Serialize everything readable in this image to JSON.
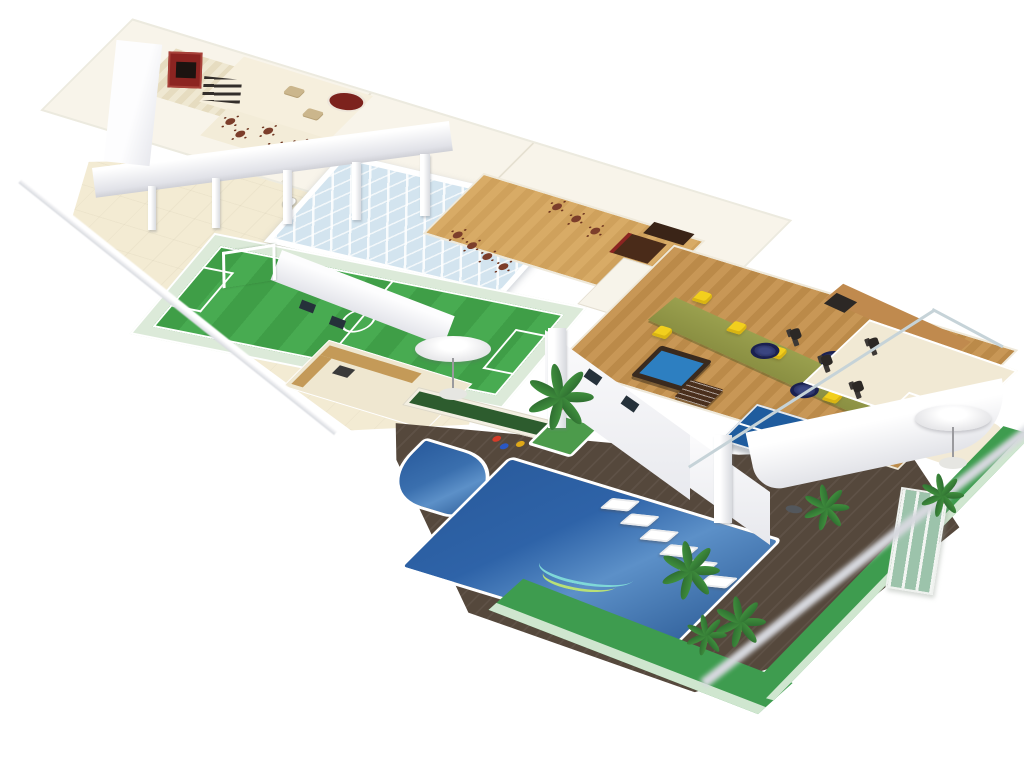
{
  "scene": {
    "type": "isometric-3d-amenity-floorplan-render",
    "areas": [
      {
        "id": "home-cinema",
        "label": "home cinema",
        "color_key": "red-wall",
        "seat_rows": 3
      },
      {
        "id": "lounge",
        "label": "lounge"
      },
      {
        "id": "round-bar",
        "label": "round bar",
        "color_key": "bar-red"
      },
      {
        "id": "upper-dining-terrace",
        "label": "roof dining terrace",
        "tables": 6
      },
      {
        "id": "skylight",
        "label": "glass skylight roof",
        "color_key": "glass-blue"
      },
      {
        "id": "party-hall",
        "label": "party hall",
        "color_key": "wood-hall",
        "tables": 7
      },
      {
        "id": "hall-bar",
        "label": "party hall bar counter"
      },
      {
        "id": "open-terrace",
        "label": "open paved terrace",
        "color_key": "terrace-sand"
      },
      {
        "id": "soccer-field",
        "label": "mini soccer field",
        "color_key": "field-green",
        "goal": 1
      },
      {
        "id": "bbq-area",
        "label": "barbecue / grill area"
      },
      {
        "id": "parasol-seating",
        "label": "parasol with table and chairs",
        "count": 2
      },
      {
        "id": "planter-hedge",
        "label": "hedge planter"
      },
      {
        "id": "kids-pool",
        "label": "kids pool",
        "color_key": "pool-blue"
      },
      {
        "id": "main-pool",
        "label": "swimming pool",
        "color_key": "pool-blue"
      },
      {
        "id": "palm-island",
        "label": "palm island planter"
      },
      {
        "id": "sun-deck",
        "label": "timber sun deck",
        "color_key": "deck-wood",
        "loungers": 6
      },
      {
        "id": "game-room",
        "label": "games terrace",
        "color_key": "wood-game",
        "billiard_tables": 1,
        "foosball_tables": 1,
        "table_tennis_tables": 1,
        "yellow_loungers": 5,
        "trampolines": 3
      },
      {
        "id": "gym",
        "label": "fitness terrace",
        "bikes": 5
      },
      {
        "id": "right-terrace",
        "label": "rounded side terrace"
      },
      {
        "id": "lawn",
        "label": "perimeter lawn edge",
        "color_key": "lawn-green"
      },
      {
        "id": "palm-trees",
        "label": "palm trees",
        "count": 6
      },
      {
        "id": "green-glass",
        "label": "green glass panel wall",
        "color_key": "glass-green"
      }
    ]
  },
  "palette": {
    "page-bg": "#ffffff",
    "terrace-sand": "#f3ebd3",
    "floor-cream": "#f8f4ea",
    "floor-stripe": "#e6dcc0",
    "wall-shade": "#e1e2e8",
    "shadow-gray": "#d6d8de",
    "red-wall": "#8c2421",
    "bar-red": "#7c221d",
    "seat-dark": "#332e2a",
    "wood-hall": "#d8ab66",
    "wood-game": "#c89756",
    "wood-cabinet": "#c08a4e",
    "wood-counter": "#c49a58",
    "bar-wood-dark": "#4a2b19",
    "chair-brown": "#7c3e2b",
    "field-green": "#3f9e47",
    "field-stripe": "#48ab51",
    "mint": "#dcead9",
    "pool-blue": "#2e63a8",
    "pool-light": "#5c90c8",
    "deck-wood": "#55483c",
    "lawn-green": "#3e9c4f",
    "lawn-light": "#cfe6cf",
    "palm-green": "#3f8f3d",
    "hedge-green": "#2d5c2e",
    "olive": "#8a8f42",
    "olive-light": "#9aa04e",
    "yellow-chair": "#f2cf1d",
    "trampoline-navy": "#272f63",
    "pingpong-blue": "#1f5c9e",
    "billiard-blue": "#2d7fc1",
    "billiard-wood": "#3a2a1e",
    "glass-blue": "#d3e4ef",
    "glass-green": "#9cc3ab",
    "equip-dark": "#2c2825",
    "window-dark": "#25313a"
  }
}
